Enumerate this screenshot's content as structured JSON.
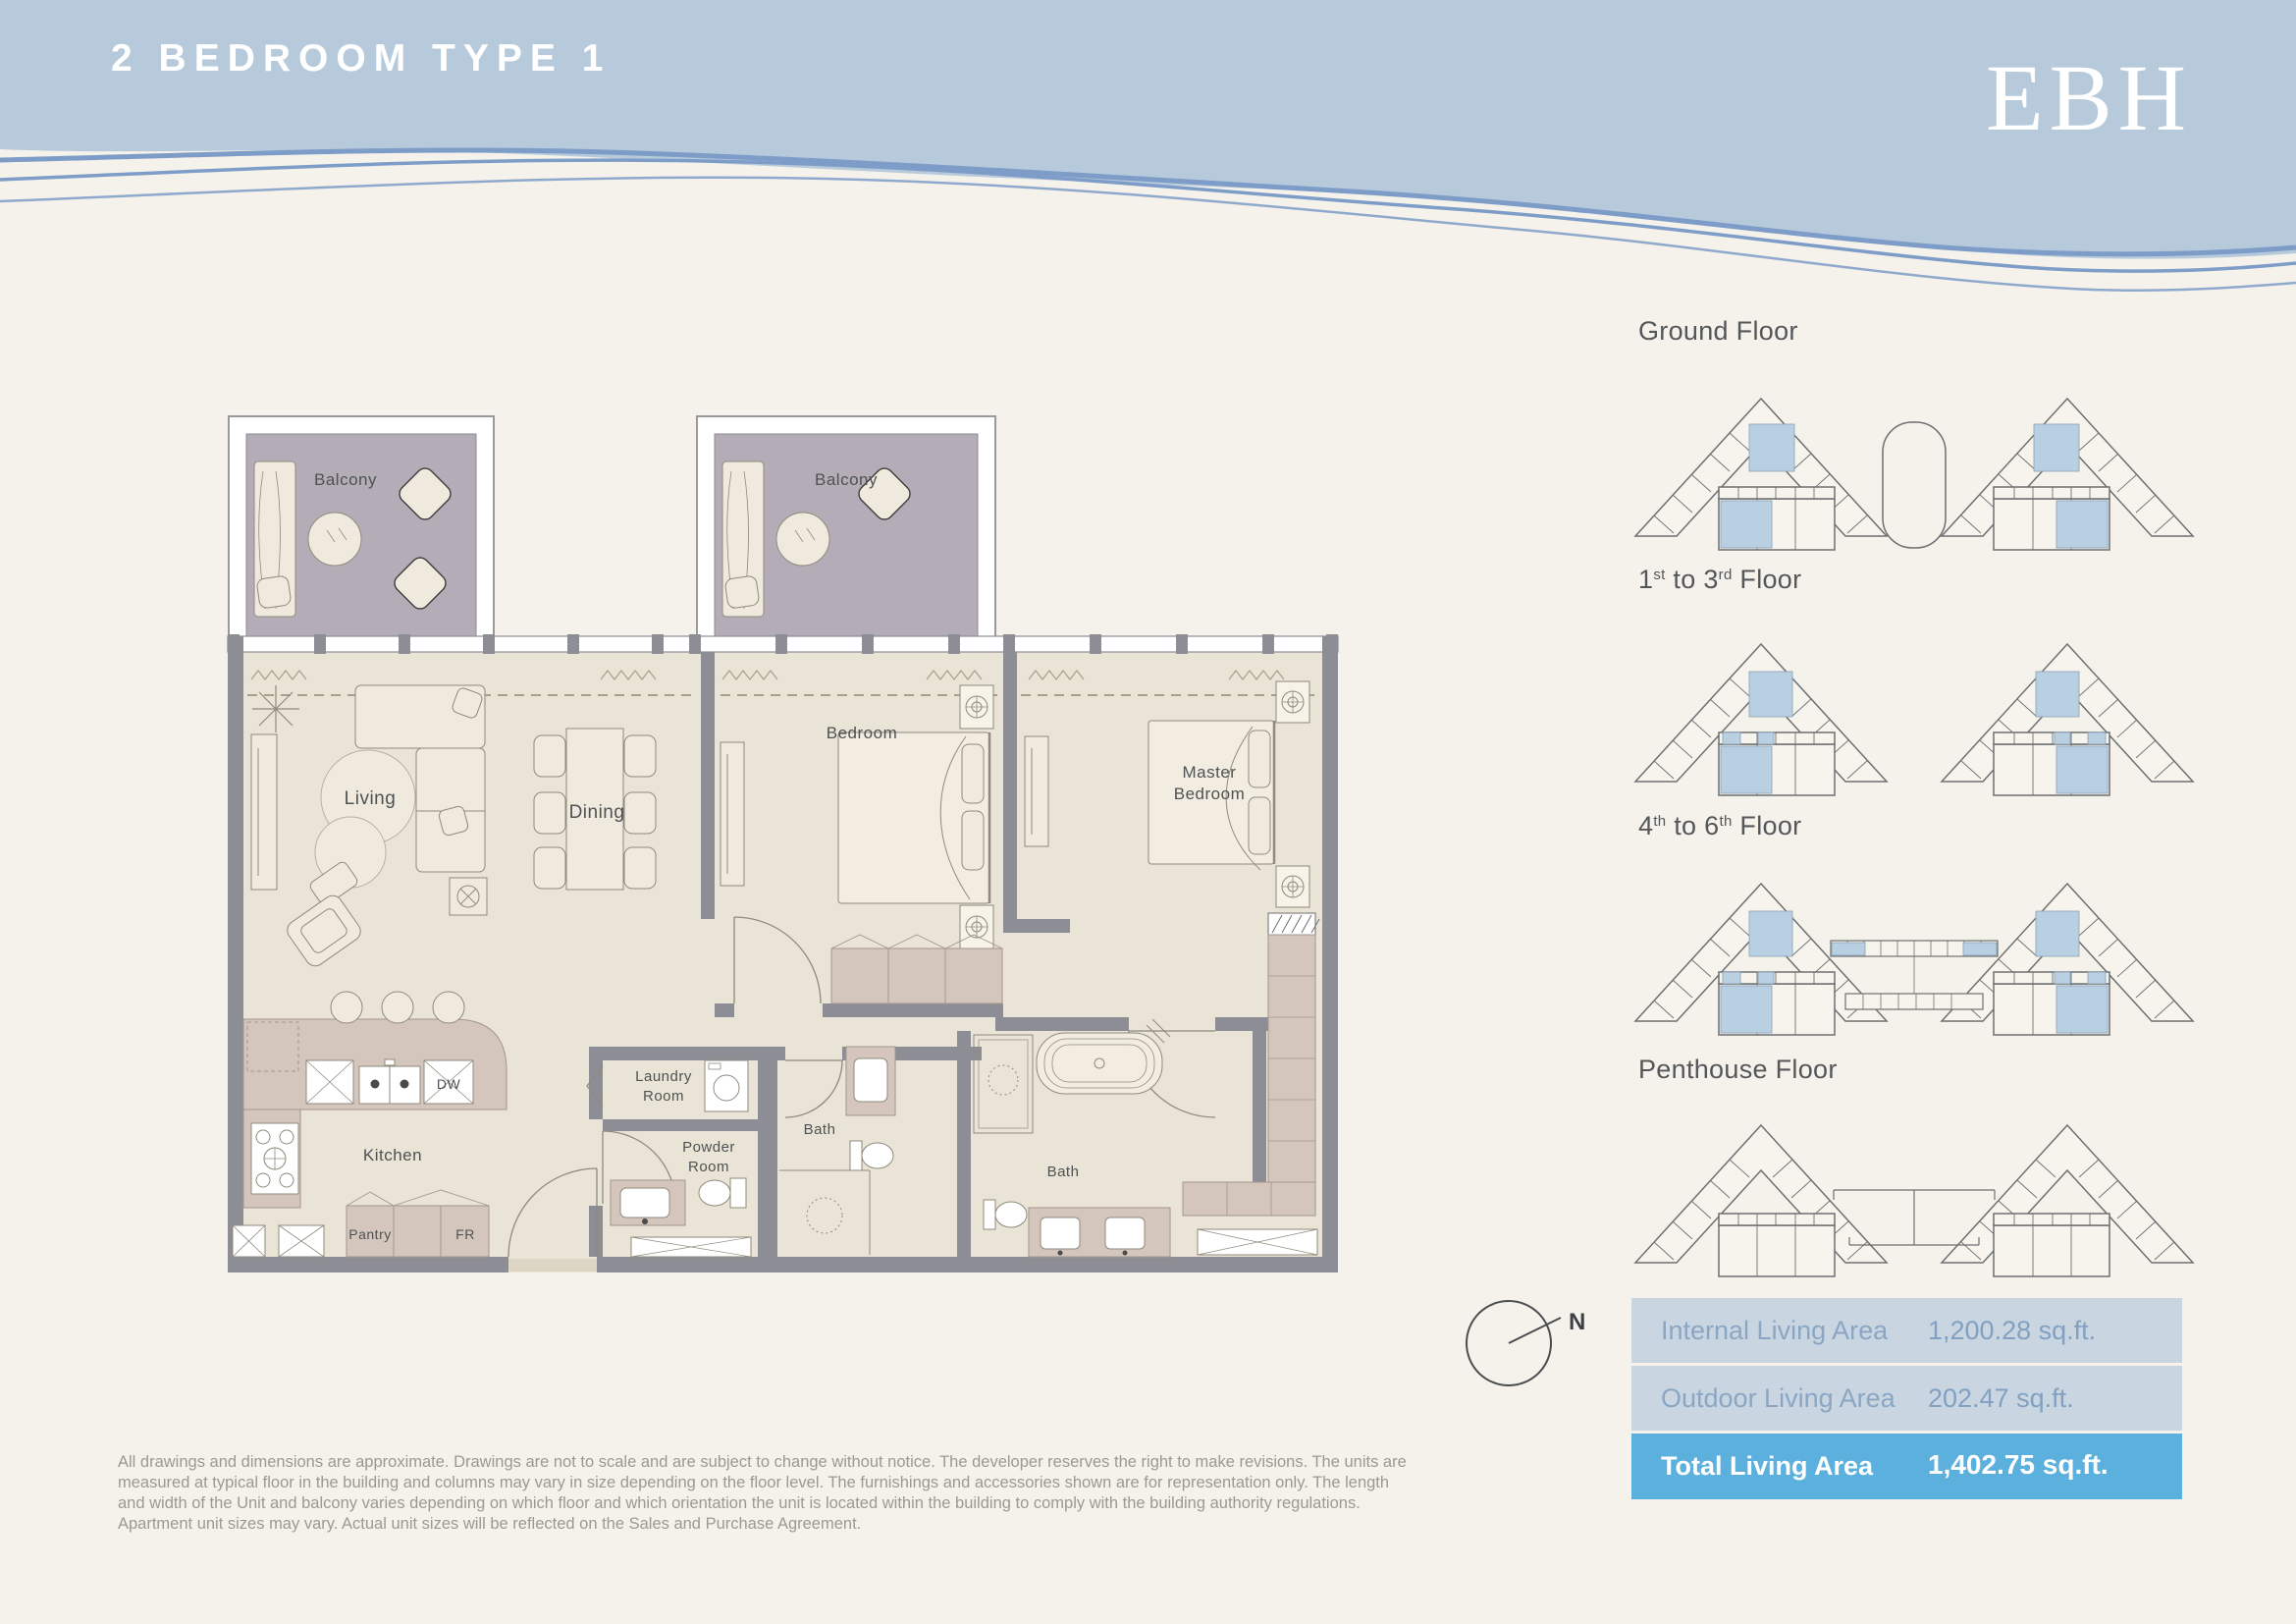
{
  "header": {
    "title": "2 BEDROOM TYPE 1",
    "logo": "EBH"
  },
  "plan": {
    "labels": {
      "balcony_left": "Balcony",
      "balcony_right": "Balcony",
      "living": "Living",
      "dining": "Dining",
      "bedroom": "Bedroom",
      "master_line1": "Master",
      "master_line2": "Bedroom",
      "kitchen": "Kitchen",
      "laundry_line1": "Laundry",
      "laundry_line2": "Room",
      "powder_line1": "Powder",
      "powder_line2": "Room",
      "bath_1": "Bath",
      "bath_2": "Bath",
      "pantry": "Pantry",
      "fridge": "FR",
      "dishwasher": "DW"
    }
  },
  "floors": [
    {
      "label": "Ground Floor"
    },
    {
      "p1": "1",
      "s1": "st",
      "p2": " to 3",
      "s2": "rd",
      "p3": " Floor"
    },
    {
      "p1": "4",
      "s1": "th",
      "p2": " to 6",
      "s2": "th",
      "p3": " Floor"
    },
    {
      "label": "Penthouse Floor"
    }
  ],
  "compass": {
    "north": "N"
  },
  "areas": {
    "rows": [
      {
        "label": "Internal Living Area",
        "value": "1,200.28 sq.ft."
      },
      {
        "label": "Outdoor Living Area",
        "value": "202.47 sq.ft."
      }
    ],
    "total": {
      "label": "Total Living Area",
      "value": "1,402.75 sq.ft."
    }
  },
  "disclaimer": "All drawings and dimensions are approximate. Drawings are not to scale and are subject to change without notice. The developer reserves the right to make revisions. The units are measured at typical floor in the building and columns may vary in size depending on the floor level. The furnishings and accessories shown are for representation only. The length and width of the Unit and balcony varies depending on which floor and which orientation the unit is located within the building to comply with the building authority regulations. Apartment unit sizes may vary. Actual unit sizes will be reflected on the Sales and Purchase Agreement.",
  "palette": {
    "header_blue": "#b7cadb",
    "wave_line": "#7e9cc8",
    "page_bg": "#f4f2ea",
    "floor_fill": "#e9e4d5",
    "wall": "#8d8d95",
    "balcony_fill": "#b4acb6",
    "cabinet": "#d5c6bd",
    "unit_highlight": "#b9cfe2",
    "table_row_bg": "#c9d6e2",
    "table_total_bg": "#5cb0dd",
    "table_text": "#85a2c2"
  }
}
